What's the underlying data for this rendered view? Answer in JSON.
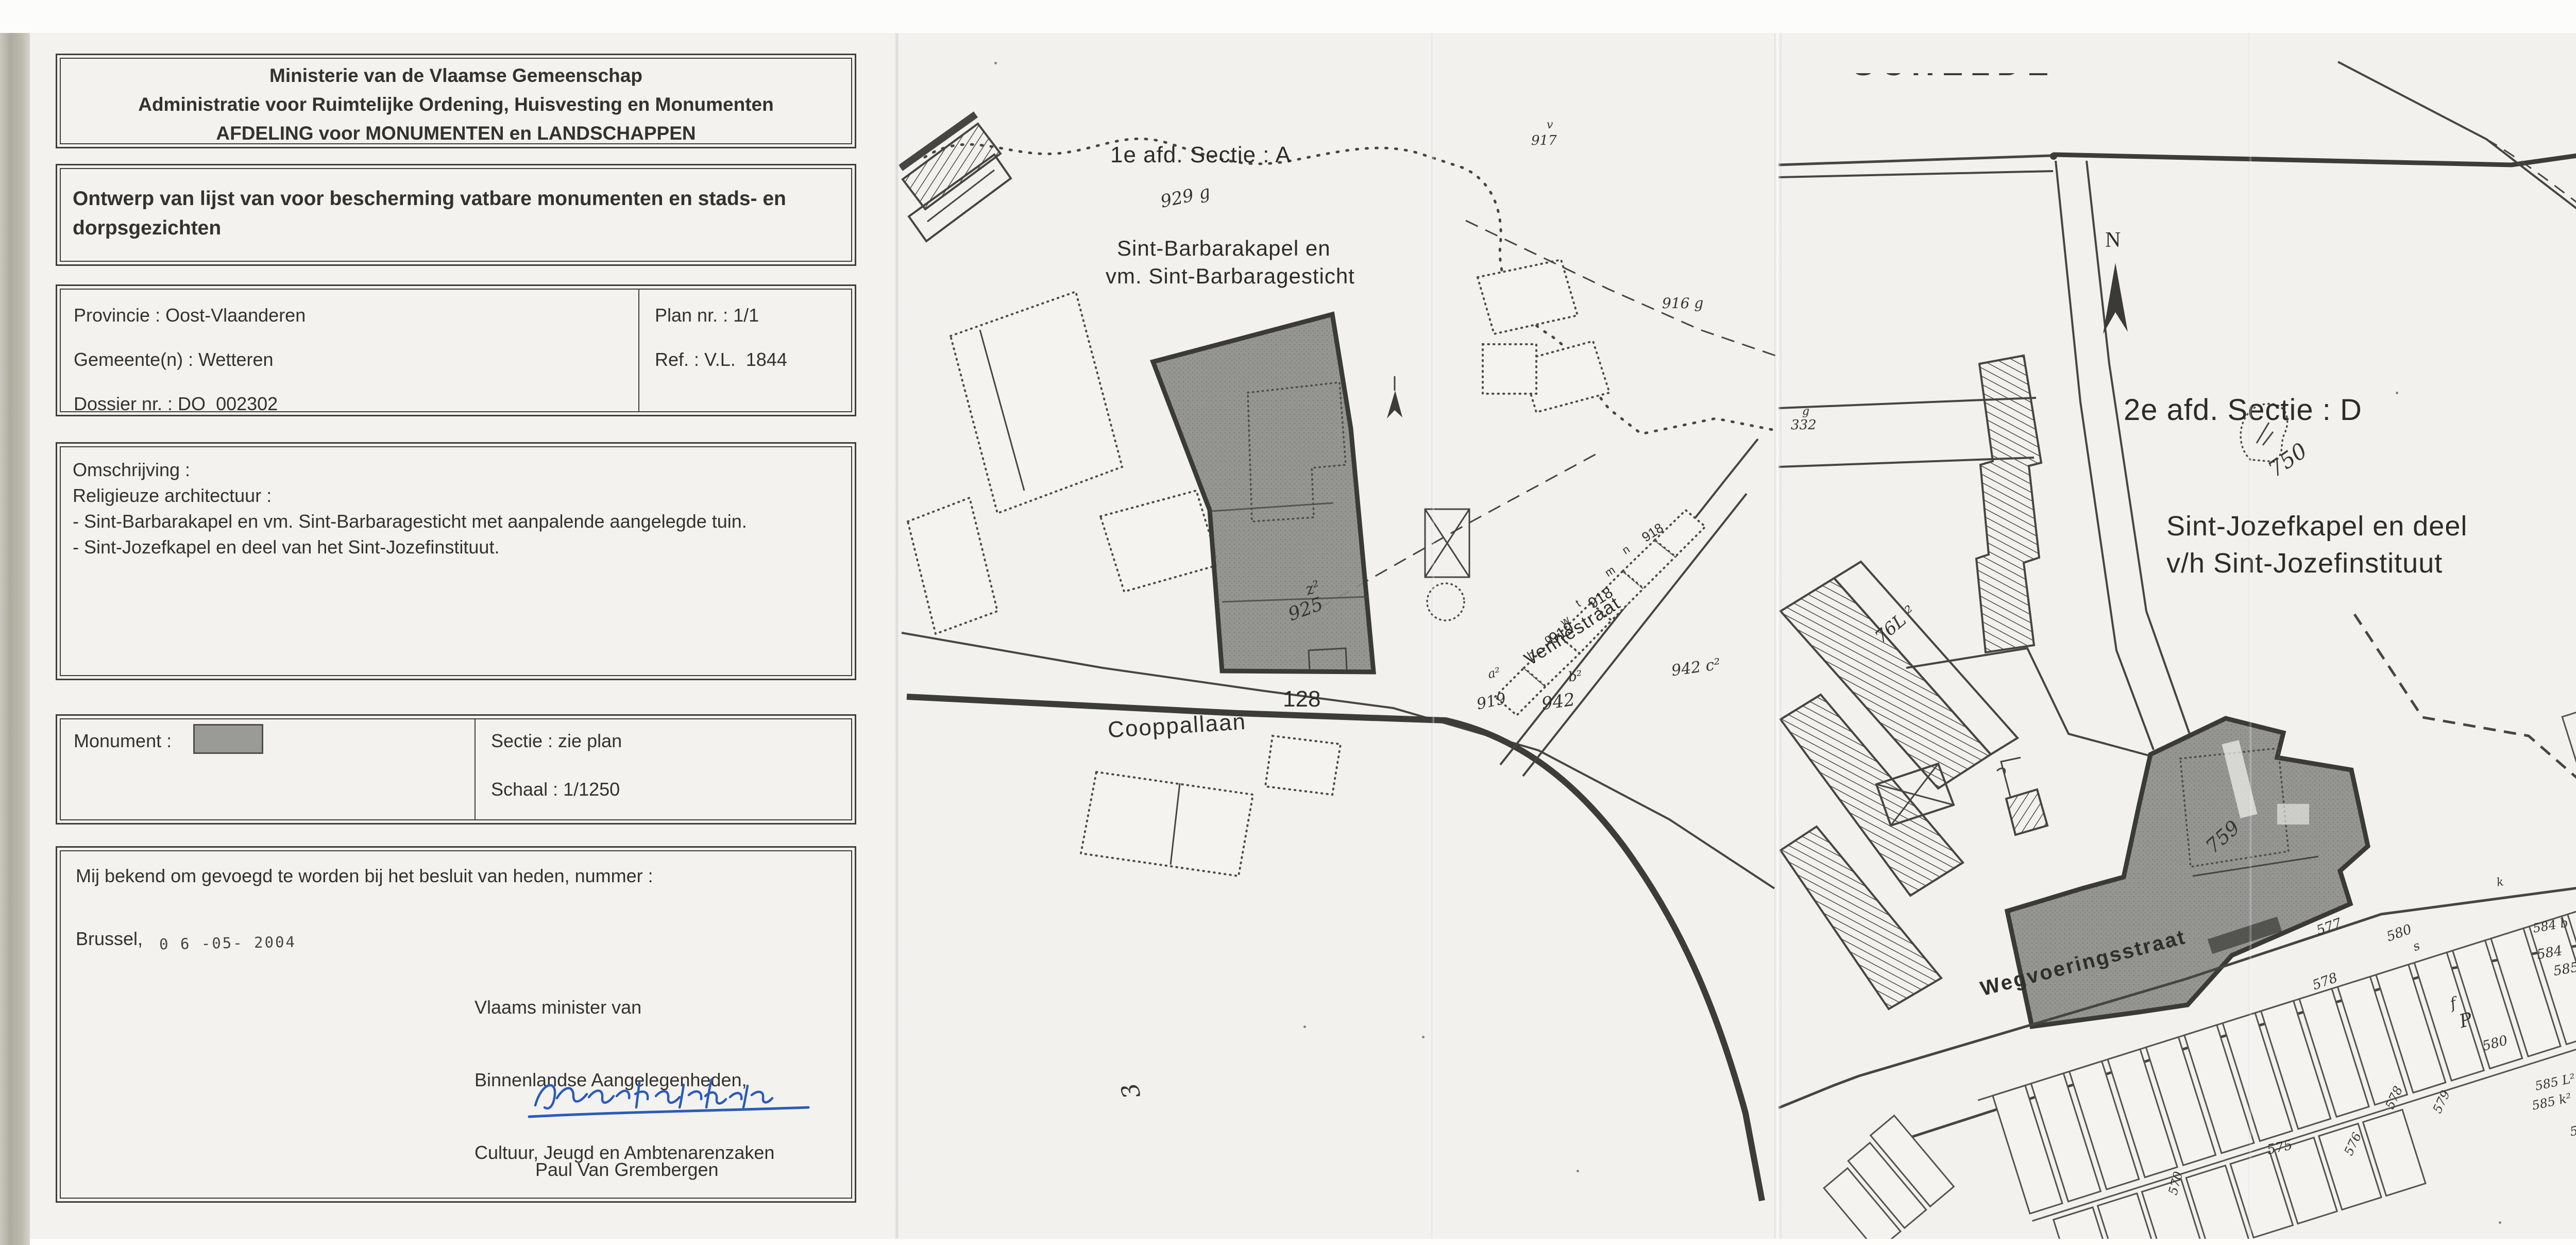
{
  "document": {
    "header_lines": [
      "Ministerie van de Vlaamse Gemeenschap",
      "Administratie voor Ruimtelijke Ordening, Huisvesting en Monumenten",
      "AFDELING voor MONUMENTEN en LANDSCHAPPEN"
    ],
    "subject": "Ontwerp van lijst van voor bescherming vatbare monumenten en stads- en dorpsgezichten",
    "province": "Provincie : Oost-Vlaanderen",
    "municipality": "Gemeente(n) : Wetteren",
    "dossier": "Dossier nr. : DO  002302",
    "plan_nr": "Plan nr. : 1/1",
    "ref": "Ref. : V.L.  1844",
    "omschrijving_title": "Omschrijving :",
    "omschrijving_sub": "Religieuze architectuur :",
    "omschrijving_items": [
      "- Sint-Barbarakapel en vm. Sint-Barbaragesticht met aanpalende aangelegde tuin.",
      "- Sint-Jozefkapel en deel van het Sint-Jozefinstituut."
    ],
    "monument_label": "Monument :",
    "sectie": "Sectie : zie plan",
    "schaal": "Schaal : 1/1250",
    "bekend_line": "Mij bekend om gevoegd te worden bij het besluit van heden, nummer :",
    "place": "Brussel,",
    "date_stamp": "0 6 -05- 2004",
    "minister_lines": [
      "Vlaams minister van",
      "Binnenlandse Aangelegenheden,",
      "Cultuur, Jeugd en Ambtenarenzaken"
    ],
    "signer": "Paul Van Grembergen"
  },
  "colors": {
    "paper": "#f3f2ef",
    "ink": "#32322e",
    "monument_fill": "#8e8e8b",
    "signature_blue": "#2a5cb8",
    "swatch_gray": "#9a9a97"
  },
  "map_a": {
    "section_title": "1e afd. Sectie : A",
    "title_lines": [
      "Sint-Barbarakapel en",
      "vm. Sint-Barbaragesticht"
    ],
    "street_1": "Cooppallaan",
    "street_2": "Vennestraat",
    "labels": [
      "929 g",
      "917",
      "v",
      "916 g",
      "z²",
      "925",
      "128",
      "918",
      "919",
      "942",
      "b²",
      "942 c²",
      "a²",
      "919",
      "h",
      "g",
      "w",
      "t",
      "m",
      "n",
      "918",
      "3"
    ]
  },
  "map_d": {
    "river": "SCHELDE",
    "north": "N",
    "section_title": "2e afd. Sectie : D",
    "title_lines": [
      "Sint-Jozefkapel en deel",
      "v/h Sint-Jozefinstituut"
    ],
    "street": "Wegvoeringsstraat",
    "labels": [
      "750",
      "759",
      "76L ²",
      "g",
      "332",
      "577",
      "578",
      "580",
      "P",
      "580",
      "578",
      "579",
      "576",
      "575",
      "584 b",
      "584",
      "585",
      "585 L²",
      "585 k²",
      "585",
      "570",
      "f",
      "s",
      "k"
    ]
  }
}
